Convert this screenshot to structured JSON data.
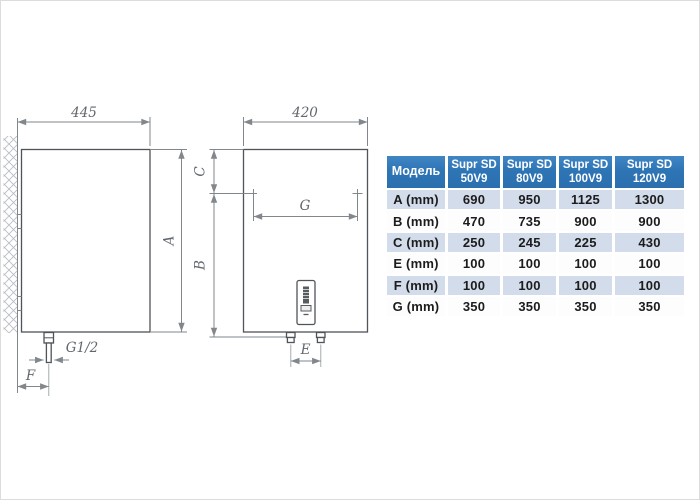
{
  "drawing": {
    "side_view": {
      "width": "445",
      "height": "A",
      "thread": "G1/2",
      "wall_offset": "F"
    },
    "front_view": {
      "width": "420",
      "top_offset": "C",
      "height": "B",
      "bracket_span": "G",
      "pipe_span": "E"
    }
  },
  "table": {
    "model_header": "Модель",
    "columns": [
      {
        "line1": "Supr SD",
        "line2": "50V9"
      },
      {
        "line1": "Supr SD",
        "line2": "80V9"
      },
      {
        "line1": "Supr SD",
        "line2": "100V9"
      },
      {
        "line1": "Supr SD",
        "line2": "120V9"
      }
    ],
    "rows": [
      {
        "label": "A (mm)",
        "values": [
          "690",
          "950",
          "1125",
          "1300"
        ]
      },
      {
        "label": "B (mm)",
        "values": [
          "470",
          "735",
          "900",
          "900"
        ]
      },
      {
        "label": "C (mm)",
        "values": [
          "250",
          "245",
          "225",
          "430"
        ]
      },
      {
        "label": "E (mm)",
        "values": [
          "100",
          "100",
          "100",
          "100"
        ]
      },
      {
        "label": "F (mm)",
        "values": [
          "100",
          "100",
          "100",
          "100"
        ]
      },
      {
        "label": "G (mm)",
        "values": [
          "350",
          "350",
          "350",
          "350"
        ]
      }
    ],
    "colors": {
      "header_bg": "#2e75b6",
      "header_text": "#ffffff",
      "row_alt_bg": "#d3dcea",
      "row_bg": "#fdfdfe",
      "cell_text": "#1c1c1c",
      "line_color": "#4e545a",
      "dim_color": "#82878c"
    }
  }
}
